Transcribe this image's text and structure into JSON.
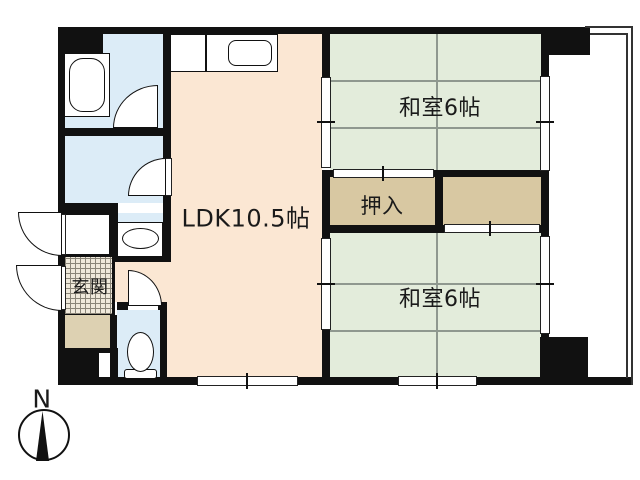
{
  "floorplan": {
    "title": "apartment-floor-plan",
    "rooms": {
      "ldk": {
        "label": "LDK10.5帖"
      },
      "washitsu_top": {
        "label": "和室6帖"
      },
      "washitsu_bottom": {
        "label": "和室6帖"
      },
      "oshiire": {
        "label": "押入"
      },
      "genkan": {
        "label": "玄関"
      }
    },
    "compass": {
      "label": "N"
    },
    "colors": {
      "wall": "#111111",
      "ldk_floor": "#fbe7d3",
      "tatami_floor": "#e3ecdb",
      "tatami_grid": "#8f988f",
      "water_floor": "#dcecf7",
      "closet_floor": "#d8c8a2",
      "hall_floor": "#ddd1b2",
      "tile_floor": "#efe9db",
      "balcony_line": "#333333"
    }
  }
}
